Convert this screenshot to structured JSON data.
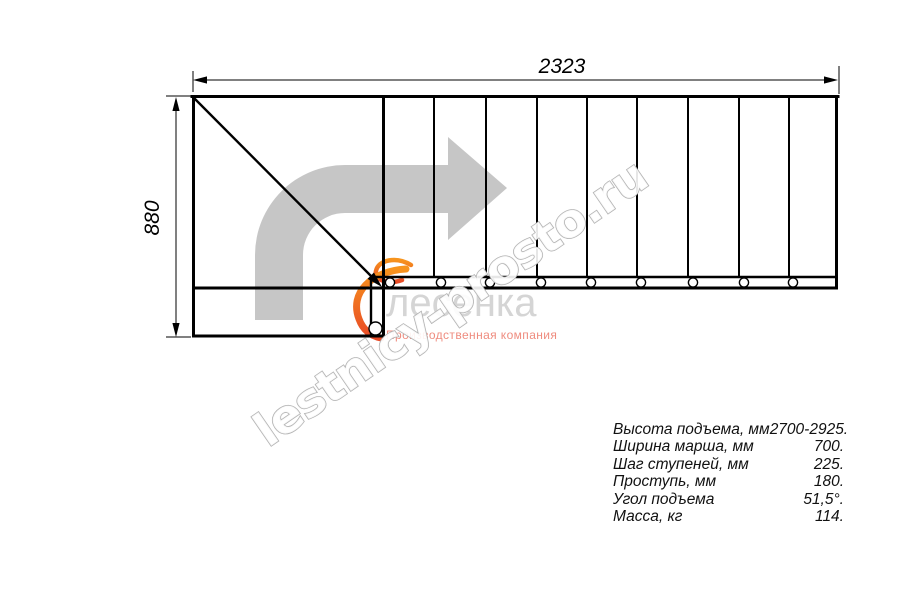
{
  "drawing": {
    "dim_width_label": "2323",
    "dim_height_label": "880"
  },
  "watermark": {
    "text": "lestnicy-prosto.ru"
  },
  "logo": {
    "name": "лесенка",
    "tagline": "Производственная компания"
  },
  "specs": {
    "rows": [
      {
        "label": "Высота подъема, мм",
        "value": "2700-2925."
      },
      {
        "label": "Ширина марша, мм",
        "value": "700."
      },
      {
        "label": "Шаг ступеней, мм",
        "value": "225."
      },
      {
        "label": "Проступь, мм",
        "value": "180."
      },
      {
        "label": "Угол подъема",
        "value": "51,5°."
      },
      {
        "label": "Масса, кг",
        "value": "114."
      }
    ]
  },
  "colors": {
    "line": "#000000",
    "direction_arrow": "#c6c6c6",
    "watermark_outline": "#b3b3b3",
    "logo_text": "#d5d5d5",
    "logo_tagline": "#ef8c7f",
    "logo_accent_start": "#f7941d",
    "logo_accent_end": "#e84a26"
  }
}
